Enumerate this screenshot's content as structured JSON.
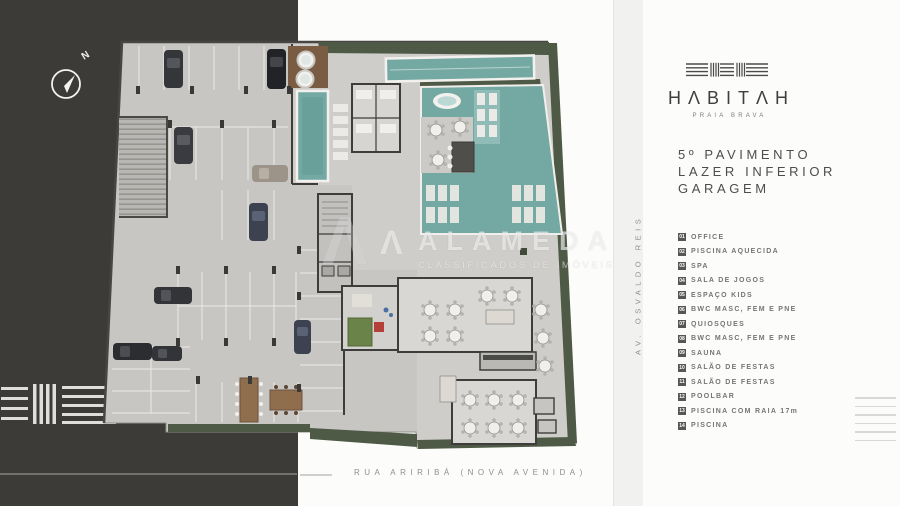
{
  "plan": {
    "compass_label": "N",
    "street_left_label": "AV. OSVALDO REIS",
    "street_bottom_label": "RUA ARIRIBÁ (NOVA AVENIDA)"
  },
  "watermark": {
    "brand": "ALAMEDA",
    "tagline": "CLASSIFICADOS DE IMÓVEIS",
    "mark_glyph": "Λ"
  },
  "brand": {
    "name": "HABITAH",
    "display": "HΛBITΛH",
    "subtitle": "PRAIA BRAVA"
  },
  "title": {
    "line1": "5º PAVIMENTO",
    "line2": "LAZER INFERIOR",
    "line3": "GARAGEM"
  },
  "legend": {
    "items": [
      {
        "num": "01",
        "label": "OFFICE"
      },
      {
        "num": "02",
        "label": "PISCINA AQUECIDA"
      },
      {
        "num": "03",
        "label": "SPA"
      },
      {
        "num": "04",
        "label": "SALA DE JOGOS"
      },
      {
        "num": "05",
        "label": "ESPAÇO KIDS"
      },
      {
        "num": "06",
        "label": "BWC MASC, FEM E PNE"
      },
      {
        "num": "07",
        "label": "QUIOSQUES"
      },
      {
        "num": "08",
        "label": "BWC MASC, FEM E PNE"
      },
      {
        "num": "09",
        "label": "SAUNA"
      },
      {
        "num": "10",
        "label": "SALÃO DE FESTAS"
      },
      {
        "num": "11",
        "label": "SALÃO DE FESTAS"
      },
      {
        "num": "12",
        "label": "POOLBAR"
      },
      {
        "num": "13",
        "label": "PISCINA COM RAIA 17m"
      },
      {
        "num": "14",
        "label": "PISCINA"
      }
    ]
  },
  "colors": {
    "street_dark": "#3c3b38",
    "pool_teal": "#74a8a2",
    "hedge_green": "#4e5a45",
    "floor_gray": "#c7c6c3",
    "panel_text": "#4d4d4b"
  }
}
